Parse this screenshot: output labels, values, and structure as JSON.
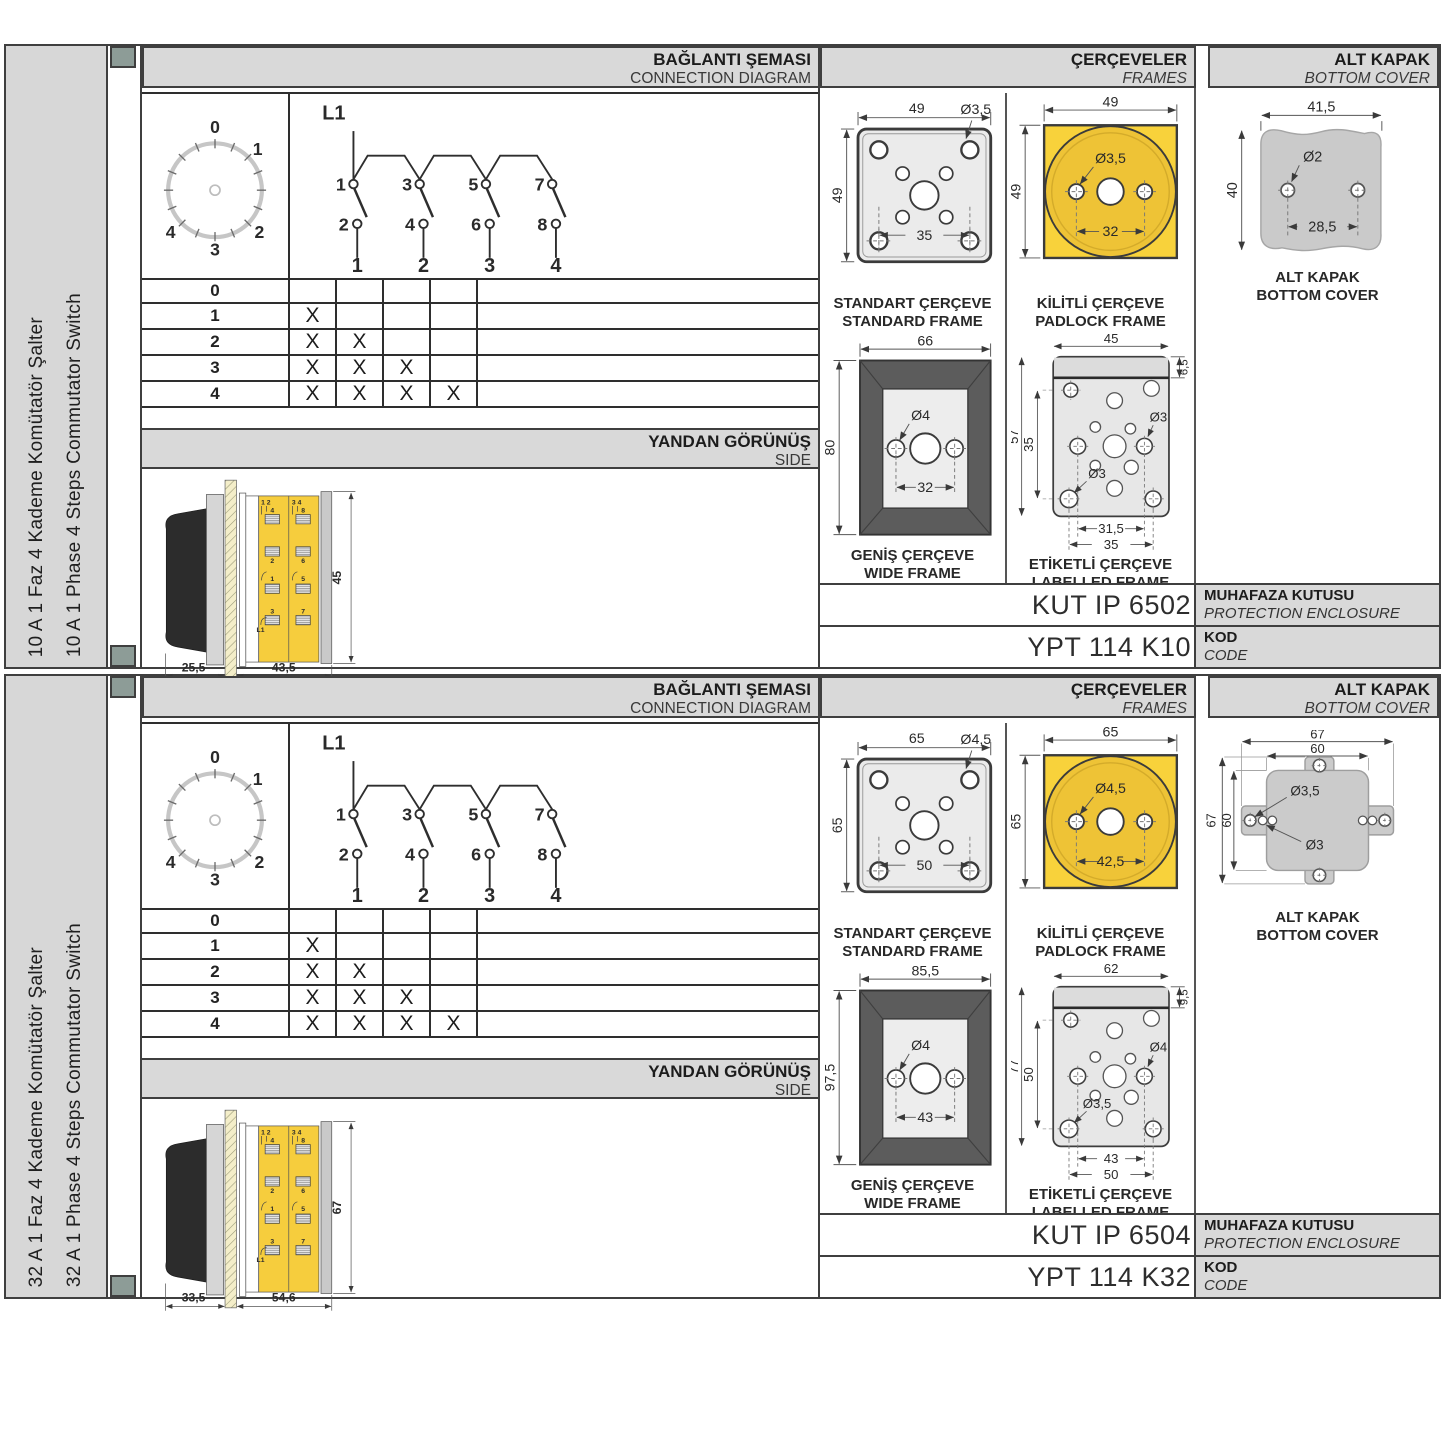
{
  "sections": [
    {
      "side_label_tr": "10 A 1 Faz 4 Kademe Komütatör Şalter",
      "side_label_en": "10 A 1 Phase 4 Steps Commutator Switch",
      "head": {
        "connection_tr": "BAĞLANTI ŞEMASI",
        "connection_en": "CONNECTION DIAGRAM",
        "frames_tr": "ÇERÇEVELER",
        "frames_en": "FRAMES",
        "cover_tr": "ALT KAPAK",
        "cover_en": "BOTTOM COVER"
      },
      "dial": {
        "p0": "0",
        "p1": "1",
        "p2": "2",
        "p3": "3",
        "p4": "4"
      },
      "diagram": {
        "line": "L1",
        "t1": "1",
        "t3": "3",
        "t5": "5",
        "t7": "7",
        "t2": "2",
        "t4": "4",
        "t6": "6",
        "t8": "8",
        "c1": "1",
        "c2": "2",
        "c3": "3",
        "c4": "4"
      },
      "table": {
        "rows": [
          {
            "label": "0",
            "m1": "",
            "m2": "",
            "m3": "",
            "m4": ""
          },
          {
            "label": "1",
            "m1": "X",
            "m2": "",
            "m3": "",
            "m4": ""
          },
          {
            "label": "2",
            "m1": "X",
            "m2": "X",
            "m3": "",
            "m4": ""
          },
          {
            "label": "3",
            "m1": "X",
            "m2": "X",
            "m3": "X",
            "m4": ""
          },
          {
            "label": "4",
            "m1": "X",
            "m2": "X",
            "m3": "X",
            "m4": "X"
          }
        ]
      },
      "side": {
        "title_tr": "YANDAN GÖRÜNÜŞ",
        "title_en": "SIDE",
        "dim_handle": "25,5",
        "dim_body": "43,5",
        "dim_height": "45",
        "pairL": "1 2",
        "pairR": "3 4",
        "tl1": "4",
        "tl2": "2",
        "tl3": "1",
        "tl4": "3",
        "tr1": "8",
        "tr2": "6",
        "tr3": "5",
        "tr4": "7",
        "line": "L1"
      },
      "frames": {
        "standard": {
          "tr": "STANDART ÇERÇEVE",
          "en": "STANDARD FRAME",
          "w": "49",
          "h": "49",
          "hole": "Ø3,5",
          "inner": "35"
        },
        "padlock": {
          "tr": "KİLİTLİ ÇERÇEVE",
          "en": "PADLOCK FRAME",
          "w": "49",
          "h": "49",
          "hole": "Ø3,5",
          "inner": "32"
        },
        "wide": {
          "tr": "GENİŞ ÇERÇEVE",
          "en": "WIDE FRAME",
          "w": "66",
          "h": "80",
          "hole": "Ø4",
          "inner": "32"
        },
        "labelled": {
          "tr": "ETİKETLİ ÇERÇEVE",
          "en": "LABELLED FRAME",
          "w": "45",
          "strip": "6,5",
          "h": "57",
          "inner_h": "35",
          "hole_right": "Ø3",
          "hole_left": "Ø3",
          "inner_w": "31,5",
          "outer_w": "35"
        }
      },
      "cover": {
        "tr": "ALT KAPAK",
        "en": "BOTTOM COVER",
        "w": "41,5",
        "h": "40",
        "hole": "Ø2",
        "inner": "28,5"
      },
      "codes": {
        "enclosure_value": "KUT IP 6502",
        "enclosure_tr": "MUHAFAZA KUTUSU",
        "enclosure_en": "PROTECTION ENCLOSURE",
        "code_value": "YPT 114 K10",
        "code_tr": "KOD",
        "code_en": "CODE"
      }
    },
    {
      "side_label_tr": "32 A 1 Faz 4 Kademe Komütatör Şalter",
      "side_label_en": "32 A 1 Phase 4 Steps Commutator Switch",
      "head": {
        "connection_tr": "BAĞLANTI ŞEMASI",
        "connection_en": "CONNECTION DIAGRAM",
        "frames_tr": "ÇERÇEVELER",
        "frames_en": "FRAMES",
        "cover_tr": "ALT KAPAK",
        "cover_en": "BOTTOM COVER"
      },
      "dial": {
        "p0": "0",
        "p1": "1",
        "p2": "2",
        "p3": "3",
        "p4": "4"
      },
      "diagram": {
        "line": "L1",
        "t1": "1",
        "t3": "3",
        "t5": "5",
        "t7": "7",
        "t2": "2",
        "t4": "4",
        "t6": "6",
        "t8": "8",
        "c1": "1",
        "c2": "2",
        "c3": "3",
        "c4": "4"
      },
      "table": {
        "rows": [
          {
            "label": "0",
            "m1": "",
            "m2": "",
            "m3": "",
            "m4": ""
          },
          {
            "label": "1",
            "m1": "X",
            "m2": "",
            "m3": "",
            "m4": ""
          },
          {
            "label": "2",
            "m1": "X",
            "m2": "X",
            "m3": "",
            "m4": ""
          },
          {
            "label": "3",
            "m1": "X",
            "m2": "X",
            "m3": "X",
            "m4": ""
          },
          {
            "label": "4",
            "m1": "X",
            "m2": "X",
            "m3": "X",
            "m4": "X"
          }
        ]
      },
      "side": {
        "title_tr": "YANDAN GÖRÜNÜŞ",
        "title_en": "SIDE",
        "dim_handle": "33,5",
        "dim_body": "54,6",
        "dim_height": "67",
        "pairL": "1 2",
        "pairR": "3 4",
        "tl1": "4",
        "tl2": "2",
        "tl3": "1",
        "tl4": "3",
        "tr1": "8",
        "tr2": "6",
        "tr3": "5",
        "tr4": "7",
        "line": "L1"
      },
      "frames": {
        "standard": {
          "tr": "STANDART ÇERÇEVE",
          "en": "STANDARD FRAME",
          "w": "65",
          "h": "65",
          "hole": "Ø4,5",
          "inner": "50"
        },
        "padlock": {
          "tr": "KİLİTLİ ÇERÇEVE",
          "en": "PADLOCK FRAME",
          "w": "65",
          "h": "65",
          "hole": "Ø4,5",
          "inner": "42,5"
        },
        "wide": {
          "tr": "GENİŞ ÇERÇEVE",
          "en": "WIDE FRAME",
          "w": "85,5",
          "h": "97,5",
          "hole": "Ø4",
          "inner": "43"
        },
        "labelled": {
          "tr": "ETİKETLİ ÇERÇEVE",
          "en": "LABELLED FRAME",
          "w": "62",
          "strip": "9,5",
          "h": "77",
          "inner_h": "50",
          "hole_right": "Ø4",
          "hole_left": "Ø3,5",
          "inner_w": "43",
          "outer_w": "50"
        }
      },
      "cover": {
        "tr": "ALT KAPAK",
        "en": "BOTTOM COVER",
        "w_outer": "67",
        "w_inner": "60",
        "h_outer": "67",
        "h_inner": "60",
        "hole_big": "Ø3,5",
        "hole_small": "Ø3"
      },
      "codes": {
        "enclosure_value": "KUT IP 6504",
        "enclosure_tr": "MUHAFAZA KUTUSU",
        "enclosure_en": "PROTECTION ENCLOSURE",
        "code_value": "YPT 114 K32",
        "code_tr": "KOD",
        "code_en": "CODE"
      }
    }
  ]
}
